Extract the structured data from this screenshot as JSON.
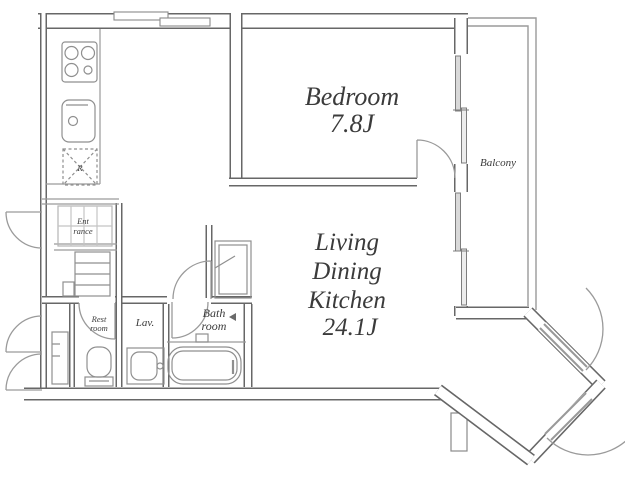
{
  "floorplan": {
    "rooms": {
      "bedroom": {
        "name": "Bedroom",
        "size": "7.8J"
      },
      "ldk": {
        "line1": "Living",
        "line2": "Dining",
        "line3": "Kitchen",
        "size": "24.1J"
      },
      "balcony": {
        "name": "Balcony"
      },
      "bathroom": {
        "line1": "Bath",
        "line2": "room"
      },
      "lavatory": {
        "name": "Lav."
      },
      "restroom": {
        "line1": "Rest",
        "line2": "room"
      },
      "entrance": {
        "line1": "Ent",
        "line2": "rance"
      },
      "refrigerator": {
        "label": "R"
      }
    },
    "colors": {
      "wall": "#676767",
      "thin_line": "#9a9a9a",
      "fixture": "#8f8f8f",
      "text": "#3b3b3b",
      "background": "#ffffff"
    }
  }
}
